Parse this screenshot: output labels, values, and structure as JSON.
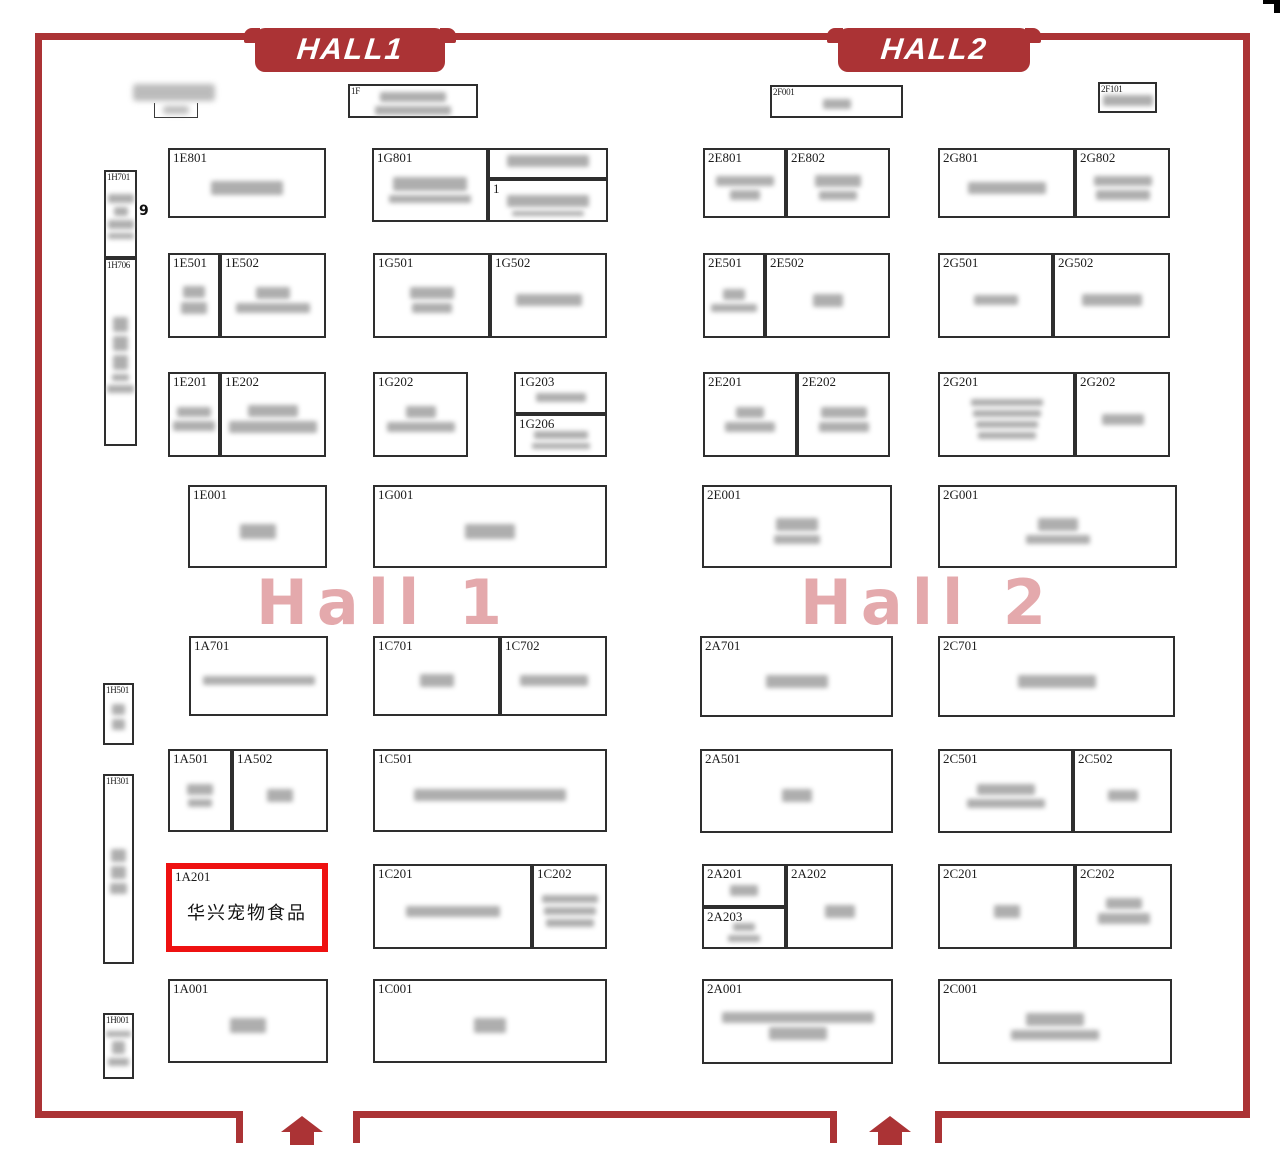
{
  "map": {
    "banners": {
      "hall1": "HALL1",
      "hall2": "HALL2"
    },
    "watermarks": {
      "hall1": "Hall 1",
      "hall2": "Hall 2"
    },
    "highlighted_booth": {
      "id": "1A201",
      "name": "华兴宠物食品",
      "highlight_color": "#ee1111"
    },
    "colors": {
      "wall_red": "#ab3335",
      "highlight_red": "#ee1111",
      "watermark_pink": "#d4757a"
    },
    "aisle_label": {
      "text": "9",
      "x": 139,
      "y": 203
    },
    "entrances": [
      {
        "x": 281,
        "y": 1116
      },
      {
        "x": 869,
        "y": 1116
      }
    ],
    "free_blurs": [
      {
        "x": 133,
        "y": 84,
        "w": 82,
        "h": 17
      },
      {
        "x": 163,
        "y": 106,
        "w": 26,
        "h": 8
      }
    ],
    "fragments": [
      {
        "x": 154,
        "y": 103,
        "w": 44,
        "h": 15
      }
    ],
    "booths": [
      {
        "id": "1F",
        "label": "1F",
        "small": true,
        "x": 348,
        "y": 84,
        "w": 130,
        "h": 34,
        "blur": [
          [
            66,
            10
          ],
          [
            76,
            9
          ]
        ]
      },
      {
        "id": "2F001",
        "label": "2F001",
        "small": true,
        "x": 770,
        "y": 85,
        "w": 133,
        "h": 33,
        "blur": [
          [
            28,
            10
          ]
        ]
      },
      {
        "id": "2F101",
        "label": "2F101",
        "small": true,
        "x": 1098,
        "y": 82,
        "w": 59,
        "h": 31,
        "blur": [
          [
            50,
            11
          ]
        ]
      },
      {
        "id": "1H701",
        "label": "1H701",
        "small": true,
        "x": 104,
        "y": 170,
        "w": 33,
        "h": 88,
        "blur": [
          [
            26,
            9
          ],
          [
            14,
            9
          ],
          [
            26,
            9
          ],
          [
            26,
            6
          ]
        ]
      },
      {
        "id": "1H706",
        "label": "1H706",
        "small": true,
        "x": 104,
        "y": 258,
        "w": 33,
        "h": 188,
        "blur": [
          [
            15,
            15
          ],
          [
            15,
            15
          ],
          [
            15,
            15
          ],
          [
            17,
            7
          ],
          [
            27,
            8
          ]
        ]
      },
      {
        "id": "1H501",
        "label": "1H501",
        "small": true,
        "x": 103,
        "y": 683,
        "w": 31,
        "h": 62,
        "blur": [
          [
            13,
            11
          ],
          [
            13,
            11
          ]
        ]
      },
      {
        "id": "1H301",
        "label": "1H301",
        "small": true,
        "x": 103,
        "y": 774,
        "w": 31,
        "h": 190,
        "blur": [
          [
            15,
            13
          ],
          [
            15,
            13
          ],
          [
            17,
            11
          ]
        ]
      },
      {
        "id": "1H001",
        "label": "1H001",
        "small": true,
        "x": 103,
        "y": 1013,
        "w": 31,
        "h": 66,
        "blur": [
          [
            25,
            6
          ],
          [
            13,
            13
          ],
          [
            21,
            8
          ]
        ]
      },
      {
        "id": "1E801",
        "label": "1E801",
        "x": 168,
        "y": 148,
        "w": 158,
        "h": 70,
        "blur": [
          [
            72,
            14
          ]
        ]
      },
      {
        "id": "1G801",
        "label": "1G801",
        "x": 372,
        "y": 148,
        "w": 116,
        "h": 74,
        "blur": [
          [
            74,
            14
          ],
          [
            82,
            8
          ]
        ]
      },
      {
        "id": "1G801-annex-top",
        "label": "",
        "x": 488,
        "y": 148,
        "w": 120,
        "h": 31,
        "blur": [
          [
            82,
            12
          ]
        ]
      },
      {
        "id": "1G801-annex-bottom",
        "label": "1",
        "x": 488,
        "y": 179,
        "w": 120,
        "h": 43,
        "blur": [
          [
            82,
            12
          ],
          [
            72,
            5
          ]
        ]
      },
      {
        "id": "1E501",
        "label": "1E501",
        "x": 168,
        "y": 253,
        "w": 52,
        "h": 85,
        "blur": [
          [
            22,
            12
          ],
          [
            26,
            12
          ]
        ]
      },
      {
        "id": "1E502",
        "label": "1E502",
        "x": 220,
        "y": 253,
        "w": 106,
        "h": 85,
        "blur": [
          [
            34,
            12
          ],
          [
            74,
            10
          ]
        ]
      },
      {
        "id": "1G501",
        "label": "1G501",
        "x": 373,
        "y": 253,
        "w": 117,
        "h": 85,
        "blur": [
          [
            44,
            12
          ],
          [
            40,
            10
          ]
        ]
      },
      {
        "id": "1G502",
        "label": "1G502",
        "x": 490,
        "y": 253,
        "w": 117,
        "h": 85,
        "blur": [
          [
            66,
            12
          ]
        ]
      },
      {
        "id": "1E201",
        "label": "1E201",
        "x": 168,
        "y": 372,
        "w": 52,
        "h": 85,
        "blur": [
          [
            34,
            10
          ],
          [
            42,
            10
          ]
        ]
      },
      {
        "id": "1E202",
        "label": "1E202",
        "x": 220,
        "y": 372,
        "w": 106,
        "h": 85,
        "blur": [
          [
            50,
            12
          ],
          [
            88,
            12
          ]
        ]
      },
      {
        "id": "1G202",
        "label": "1G202",
        "x": 373,
        "y": 372,
        "w": 95,
        "h": 85,
        "blur": [
          [
            30,
            12
          ],
          [
            68,
            10
          ]
        ]
      },
      {
        "id": "1G203",
        "label": "1G203",
        "x": 514,
        "y": 372,
        "w": 93,
        "h": 42,
        "blur": [
          [
            50,
            9
          ]
        ]
      },
      {
        "id": "1G206",
        "label": "1G206",
        "x": 514,
        "y": 414,
        "w": 93,
        "h": 43,
        "blur": [
          [
            54,
            8
          ],
          [
            58,
            6
          ]
        ]
      },
      {
        "id": "1E001",
        "label": "1E001",
        "x": 188,
        "y": 485,
        "w": 139,
        "h": 83,
        "blur": [
          [
            36,
            15
          ]
        ]
      },
      {
        "id": "1G001",
        "label": "1G001",
        "x": 373,
        "y": 485,
        "w": 234,
        "h": 83,
        "blur": [
          [
            50,
            15
          ]
        ]
      },
      {
        "id": "1A701",
        "label": "1A701",
        "x": 189,
        "y": 636,
        "w": 139,
        "h": 80,
        "blur": [
          [
            112,
            9
          ]
        ]
      },
      {
        "id": "1C701",
        "label": "1C701",
        "x": 373,
        "y": 636,
        "w": 127,
        "h": 80,
        "blur": [
          [
            34,
            13
          ]
        ]
      },
      {
        "id": "1C702",
        "label": "1C702",
        "x": 500,
        "y": 636,
        "w": 107,
        "h": 80,
        "blur": [
          [
            68,
            11
          ]
        ]
      },
      {
        "id": "1A501",
        "label": "1A501",
        "x": 168,
        "y": 749,
        "w": 64,
        "h": 83,
        "blur": [
          [
            26,
            11
          ],
          [
            24,
            8
          ]
        ]
      },
      {
        "id": "1A502",
        "label": "1A502",
        "x": 232,
        "y": 749,
        "w": 96,
        "h": 83,
        "blur": [
          [
            26,
            13
          ]
        ]
      },
      {
        "id": "1C501",
        "label": "1C501",
        "x": 373,
        "y": 749,
        "w": 234,
        "h": 83,
        "blur": [
          [
            152,
            12
          ]
        ]
      },
      {
        "id": "1A201",
        "label": "1A201",
        "x": 166,
        "y": 863,
        "w": 162,
        "h": 89,
        "highlight": true,
        "text": "华兴宠物食品"
      },
      {
        "id": "1C201",
        "label": "1C201",
        "x": 373,
        "y": 864,
        "w": 159,
        "h": 85,
        "blur": [
          [
            94,
            11
          ]
        ]
      },
      {
        "id": "1C202",
        "label": "1C202",
        "x": 532,
        "y": 864,
        "w": 75,
        "h": 85,
        "blur": [
          [
            56,
            8
          ],
          [
            52,
            8
          ],
          [
            48,
            8
          ]
        ]
      },
      {
        "id": "1A001",
        "label": "1A001",
        "x": 168,
        "y": 979,
        "w": 160,
        "h": 84,
        "blur": [
          [
            36,
            15
          ]
        ]
      },
      {
        "id": "1C001",
        "label": "1C001",
        "x": 373,
        "y": 979,
        "w": 234,
        "h": 84,
        "blur": [
          [
            32,
            15
          ]
        ]
      },
      {
        "id": "2E801",
        "label": "2E801",
        "x": 703,
        "y": 148,
        "w": 83,
        "h": 70,
        "blur": [
          [
            58,
            10
          ],
          [
            30,
            10
          ]
        ]
      },
      {
        "id": "2E802",
        "label": "2E802",
        "x": 786,
        "y": 148,
        "w": 104,
        "h": 70,
        "blur": [
          [
            46,
            12
          ],
          [
            38,
            9
          ]
        ]
      },
      {
        "id": "2G801",
        "label": "2G801",
        "x": 938,
        "y": 148,
        "w": 137,
        "h": 70,
        "blur": [
          [
            78,
            12
          ]
        ]
      },
      {
        "id": "2G802",
        "label": "2G802",
        "x": 1075,
        "y": 148,
        "w": 95,
        "h": 70,
        "blur": [
          [
            58,
            10
          ],
          [
            54,
            10
          ]
        ]
      },
      {
        "id": "2E501",
        "label": "2E501",
        "x": 703,
        "y": 253,
        "w": 62,
        "h": 85,
        "blur": [
          [
            22,
            11
          ],
          [
            46,
            8
          ]
        ]
      },
      {
        "id": "2E502",
        "label": "2E502",
        "x": 765,
        "y": 253,
        "w": 125,
        "h": 85,
        "blur": [
          [
            30,
            13
          ]
        ]
      },
      {
        "id": "2G501",
        "label": "2G501",
        "x": 938,
        "y": 253,
        "w": 115,
        "h": 85,
        "blur": [
          [
            44,
            10
          ]
        ]
      },
      {
        "id": "2G502",
        "label": "2G502",
        "x": 1053,
        "y": 253,
        "w": 117,
        "h": 85,
        "blur": [
          [
            60,
            12
          ]
        ]
      },
      {
        "id": "2E201",
        "label": "2E201",
        "x": 703,
        "y": 372,
        "w": 94,
        "h": 85,
        "blur": [
          [
            28,
            11
          ],
          [
            50,
            10
          ]
        ]
      },
      {
        "id": "2E202",
        "label": "2E202",
        "x": 797,
        "y": 372,
        "w": 93,
        "h": 85,
        "blur": [
          [
            46,
            11
          ],
          [
            50,
            10
          ]
        ]
      },
      {
        "id": "2G201",
        "label": "2G201",
        "x": 938,
        "y": 372,
        "w": 137,
        "h": 85,
        "blur": [
          [
            72,
            7
          ],
          [
            68,
            7
          ],
          [
            62,
            7
          ],
          [
            58,
            7
          ]
        ]
      },
      {
        "id": "2G202",
        "label": "2G202",
        "x": 1075,
        "y": 372,
        "w": 95,
        "h": 85,
        "blur": [
          [
            42,
            11
          ]
        ]
      },
      {
        "id": "2E001",
        "label": "2E001",
        "x": 702,
        "y": 485,
        "w": 190,
        "h": 83,
        "blur": [
          [
            42,
            13
          ],
          [
            46,
            9
          ]
        ]
      },
      {
        "id": "2G001",
        "label": "2G001",
        "x": 938,
        "y": 485,
        "w": 239,
        "h": 83,
        "blur": [
          [
            40,
            13
          ],
          [
            64,
            9
          ]
        ]
      },
      {
        "id": "2A701",
        "label": "2A701",
        "x": 700,
        "y": 636,
        "w": 193,
        "h": 81,
        "blur": [
          [
            62,
            13
          ]
        ]
      },
      {
        "id": "2C701",
        "label": "2C701",
        "x": 938,
        "y": 636,
        "w": 237,
        "h": 81,
        "blur": [
          [
            78,
            13
          ]
        ]
      },
      {
        "id": "2A501",
        "label": "2A501",
        "x": 700,
        "y": 749,
        "w": 193,
        "h": 84,
        "blur": [
          [
            30,
            13
          ]
        ]
      },
      {
        "id": "2C501",
        "label": "2C501",
        "x": 938,
        "y": 749,
        "w": 135,
        "h": 84,
        "blur": [
          [
            58,
            11
          ],
          [
            78,
            9
          ]
        ]
      },
      {
        "id": "2C502",
        "label": "2C502",
        "x": 1073,
        "y": 749,
        "w": 99,
        "h": 84,
        "blur": [
          [
            30,
            11
          ]
        ]
      },
      {
        "id": "2A201",
        "label": "2A201",
        "x": 702,
        "y": 864,
        "w": 84,
        "h": 43,
        "blur": [
          [
            28,
            11
          ]
        ]
      },
      {
        "id": "2A203",
        "label": "2A203",
        "x": 702,
        "y": 907,
        "w": 84,
        "h": 42,
        "blur": [
          [
            22,
            8
          ],
          [
            32,
            7
          ]
        ]
      },
      {
        "id": "2A202",
        "label": "2A202",
        "x": 786,
        "y": 864,
        "w": 107,
        "h": 85,
        "blur": [
          [
            30,
            13
          ]
        ]
      },
      {
        "id": "2C201",
        "label": "2C201",
        "x": 938,
        "y": 864,
        "w": 137,
        "h": 85,
        "blur": [
          [
            26,
            13
          ]
        ]
      },
      {
        "id": "2C202",
        "label": "2C202",
        "x": 1075,
        "y": 864,
        "w": 97,
        "h": 85,
        "blur": [
          [
            36,
            11
          ],
          [
            52,
            11
          ]
        ]
      },
      {
        "id": "2A001",
        "label": "2A001",
        "x": 702,
        "y": 979,
        "w": 191,
        "h": 85,
        "blur": [
          [
            152,
            11
          ],
          [
            58,
            13
          ]
        ]
      },
      {
        "id": "2C001",
        "label": "2C001",
        "x": 938,
        "y": 979,
        "w": 234,
        "h": 85,
        "blur": [
          [
            58,
            13
          ],
          [
            88,
            10
          ]
        ]
      }
    ]
  }
}
